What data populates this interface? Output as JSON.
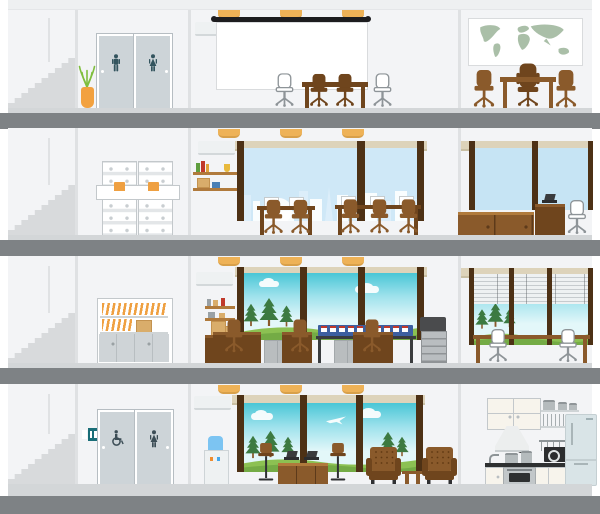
{
  "palette": {
    "bg": "#ffffff",
    "wall": "#f3f4f6",
    "divider": "#dfe1e3",
    "roof": "#eef0f1",
    "surface": "#d3d6d8",
    "slab": "#7e8285",
    "stairs": "#d8dadc",
    "cornerLine": "#e0e2e4",
    "door": "#cdd4d8",
    "doorEdge": "#b6bdc2",
    "iconTeal": "#33545e",
    "iconSlate": "#3c4d56",
    "signTeal": "#1a6e78",
    "pot": "#f2a13f",
    "leaf": "#7fbe3e",
    "light": "#eeb257",
    "screenBar": "#1d1d1f",
    "boardEdge": "#d9dbdd",
    "woodDark": "#6f451d",
    "wood": "#8a5a2b",
    "woodLight": "#b07a3c",
    "frame": "#4d3115",
    "beam": "#ddd3ba",
    "beamEdge": "#c9bfa3",
    "citySky": "#cfe8f7",
    "plainSky": "#c6e4f4",
    "skyTop": "#49c6d6",
    "skyLow": "#e3f7f9",
    "grass": "#8cc152",
    "grassDark": "#74ab45",
    "pine": "#3c7a41",
    "map": "#aabfa8",
    "cab": "#e3e6e8",
    "cabLine": "#c3c8cb",
    "folder": "#efa041",
    "workBlue": "#3d5fa0",
    "red": "#c0392b",
    "prnLight": "#b9bdc0",
    "prnDark": "#4a4b4d",
    "slat": "#eef1f2",
    "slatLine": "#c6cbce",
    "cooler": "#45a8ec",
    "cream": "#f7f4ec",
    "counter": "#2e3031",
    "steel": "#c2c7c9",
    "fridge": "#d9e4e7",
    "boxTan": "#d9ad6b",
    "gray": "#9aa1a5",
    "chairLine": "#8e9498",
    "white": "#ffffff"
  },
  "scene": {
    "type": "flat-vector office building cutaway illustration",
    "floors_count": 4,
    "ceiling_lights_per_middle_room": 3,
    "text_content": "none (illustration has no text)"
  },
  "building": {
    "floors": [
      {
        "level": 1,
        "rooms": [
          {
            "name": "stairwell",
            "items": [
              "staircase"
            ]
          },
          {
            "name": "restroom-hallway",
            "items": [
              "mens-restroom-door",
              "womens-restroom-door",
              "potted-plant"
            ]
          },
          {
            "name": "presentation-room",
            "items": [
              "air-conditioner",
              "3-ceiling-lights",
              "projection-screen",
              "conference-table",
              "2-brown-task-chairs",
              "2-white-guest-chairs"
            ]
          },
          {
            "name": "executive-office",
            "items": [
              "world-map-board",
              "executive-desk",
              "executive-chair",
              "2-guest-chairs"
            ]
          }
        ]
      },
      {
        "level": 2,
        "rooms": [
          {
            "name": "stairwell",
            "items": [
              "staircase"
            ]
          },
          {
            "name": "archive-room",
            "items": [
              "filing-cabinets-4-columns",
              "pulled-drawer-with-orange-folders"
            ]
          },
          {
            "name": "open-office",
            "items": [
              "wall-shelf-with-books",
              "air-conditioner",
              "3-ceiling-lights",
              "city-view-window",
              "2-workstation-desks",
              "5-monitors",
              "5-office-chairs"
            ]
          },
          {
            "name": "private-office",
            "items": [
              "window",
              "sideboard-cabinets",
              "desk-with-laptop",
              "office-chair"
            ]
          }
        ]
      },
      {
        "level": 3,
        "rooms": [
          {
            "name": "stairwell",
            "items": [
              "staircase"
            ]
          },
          {
            "name": "storage-room",
            "items": [
              "storage-cabinet-with-folders",
              "cardboard-boxes"
            ]
          },
          {
            "name": "workspace",
            "items": [
              "air-conditioner",
              "wall-shelf",
              "supply-counter-with-boxes",
              "3-ceiling-lights",
              "landscape-window-with-pines",
              "3-panel-desks",
              "3-office-chairs",
              "blue-workstation-row",
              "2-low-gray-cabinets",
              "copier-printer"
            ]
          },
          {
            "name": "meeting-corner",
            "items": [
              "window-with-venetian-blinds",
              "landscape-view",
              "long-table",
              "2-white-chairs"
            ]
          }
        ]
      },
      {
        "level": 4,
        "rooms": [
          {
            "name": "stairwell",
            "items": [
              "staircase"
            ]
          },
          {
            "name": "restroom-hallway",
            "items": [
              "restroom-wall-sign",
              "accessible-restroom-door",
              "womens-restroom-door"
            ]
          },
          {
            "name": "lounge-cafe",
            "items": [
              "air-conditioner",
              "water-cooler",
              "3-ceiling-lights",
              "landscape-window-with-airplane",
              "bar-counter",
              "2-laptops",
              "2-bar-stools",
              "2-tufted-armchairs",
              "side-table"
            ]
          },
          {
            "name": "kitchen",
            "items": [
              "upper-cabinets",
              "dish-shelves",
              "pots",
              "hanging-utensil-rail",
              "frying-pan",
              "range-hood",
              "sink-faucet",
              "stove-pots",
              "counter",
              "base-cabinets",
              "oven",
              "microwave",
              "refrigerator"
            ]
          }
        ]
      }
    ]
  }
}
